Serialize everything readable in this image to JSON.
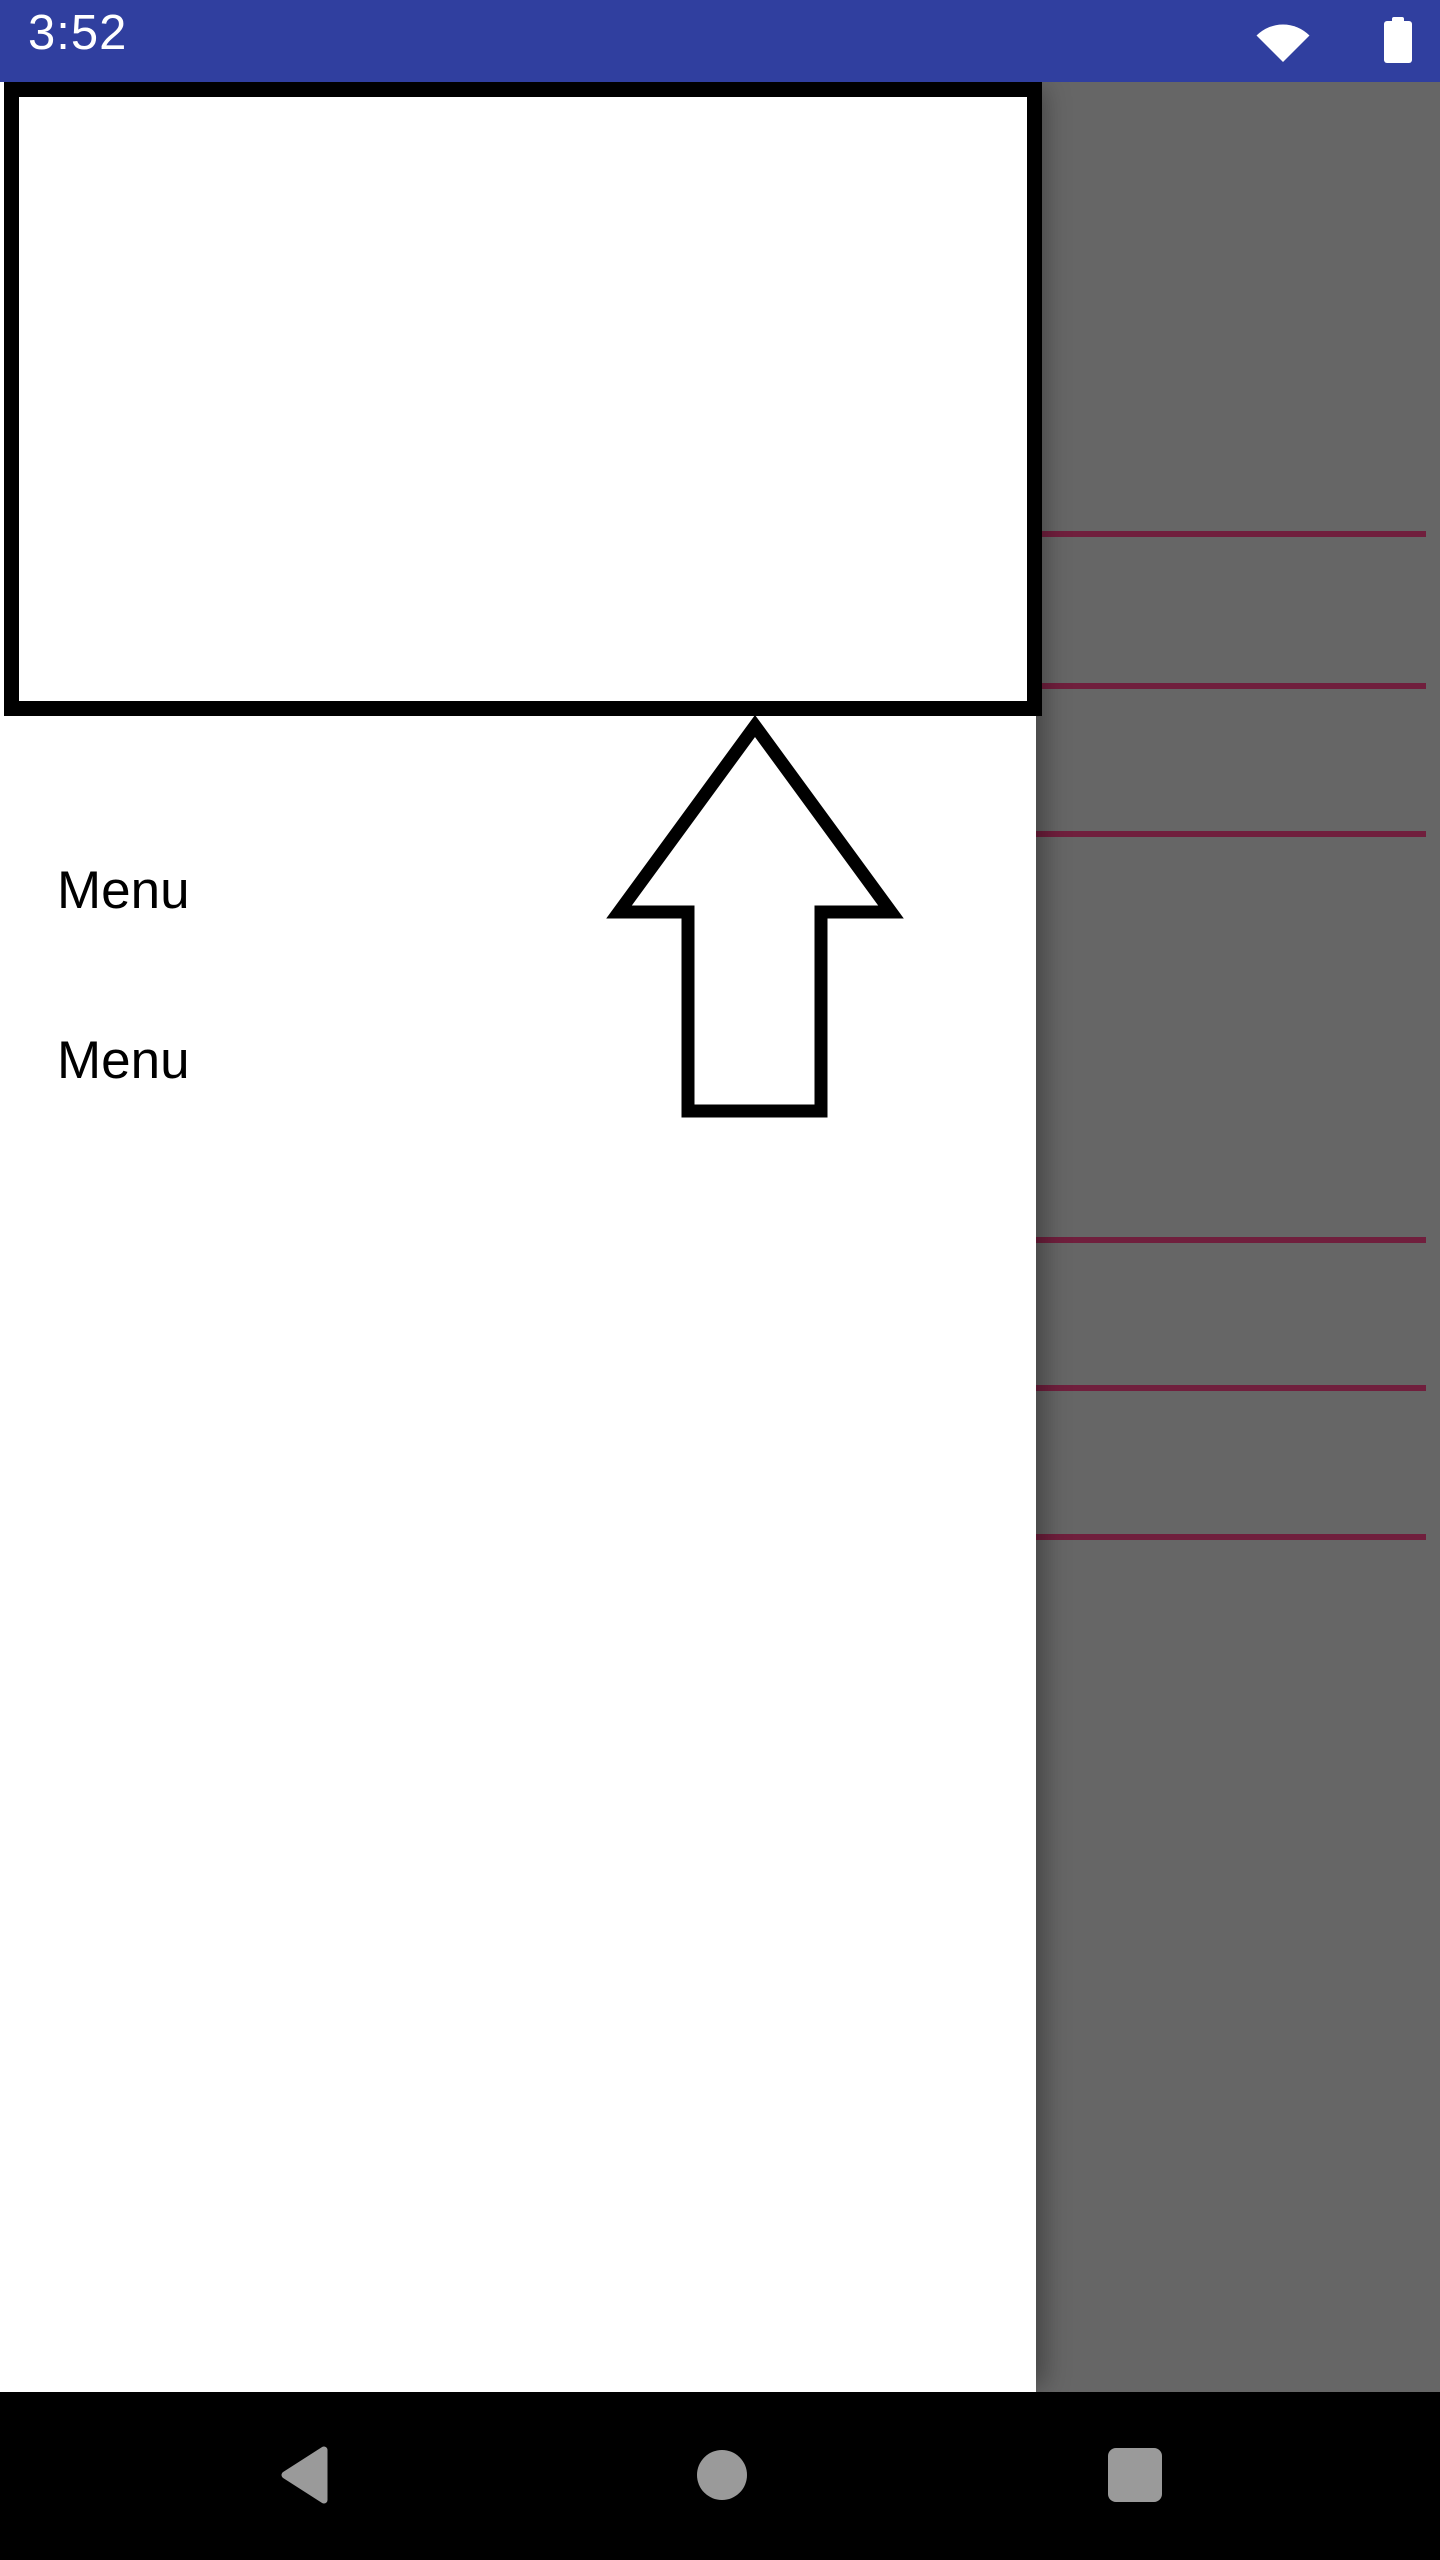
{
  "status_bar": {
    "time": "3:52",
    "bg_color": "#303F9F",
    "icons": [
      {
        "name": "wifi-icon"
      },
      {
        "name": "battery-icon"
      }
    ]
  },
  "drawer": {
    "menu_items": [
      {
        "label": "Menu"
      },
      {
        "label": "Menu"
      }
    ]
  },
  "content_overlay": {
    "scrim_color": "#666666",
    "divider_color": "#701F3D",
    "divider_tops": [
      531,
      683,
      831,
      1237,
      1385,
      1534
    ]
  },
  "nav_bar": {
    "bg_color": "#000000",
    "icon_color": "#9A9A9A",
    "buttons": [
      {
        "name": "back"
      },
      {
        "name": "home"
      },
      {
        "name": "recents"
      }
    ]
  }
}
